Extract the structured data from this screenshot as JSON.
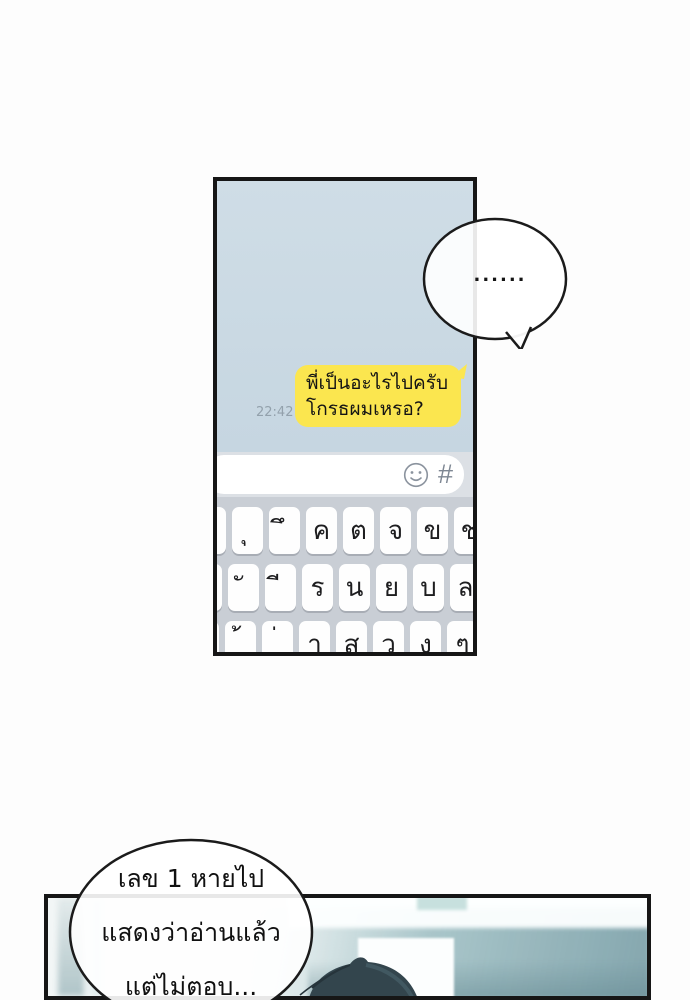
{
  "phone_chat": {
    "incoming_bubble": {
      "text": "......"
    },
    "outgoing_message": {
      "lines": [
        "พี่เป็นอะไรไปครับ",
        "โกรธผมเหรอ?"
      ],
      "time": "22:42",
      "bubble_color": "#fbe64f"
    },
    "input_bar": {
      "value": "",
      "hash_symbol": "#",
      "emoji_icon": "smiley-icon"
    },
    "keyboard": {
      "rows": [
        {
          "keys": [
            "ถ",
            "ุ",
            "ึ",
            "ค",
            "ต",
            "จ",
            "ข",
            "ช"
          ]
        },
        {
          "keys": [
            "ะ",
            "ั",
            "ี",
            "ร",
            "น",
            "ย",
            "บ",
            "ล"
          ]
        },
        {
          "keys": [
            "เ",
            "้",
            "่",
            "า",
            "ส",
            "ว",
            "ง",
            "ๆ"
          ]
        }
      ]
    },
    "colors": {
      "chat_background": "#c9d8e2",
      "keyboard_background": "#c9ced5",
      "panel_border": "#161616"
    }
  },
  "narration_bubble": {
    "lines": [
      "เลข 1 หายไป",
      "แสดงว่าอ่านแล้ว",
      "แต่ไม่ตอบ..."
    ]
  }
}
